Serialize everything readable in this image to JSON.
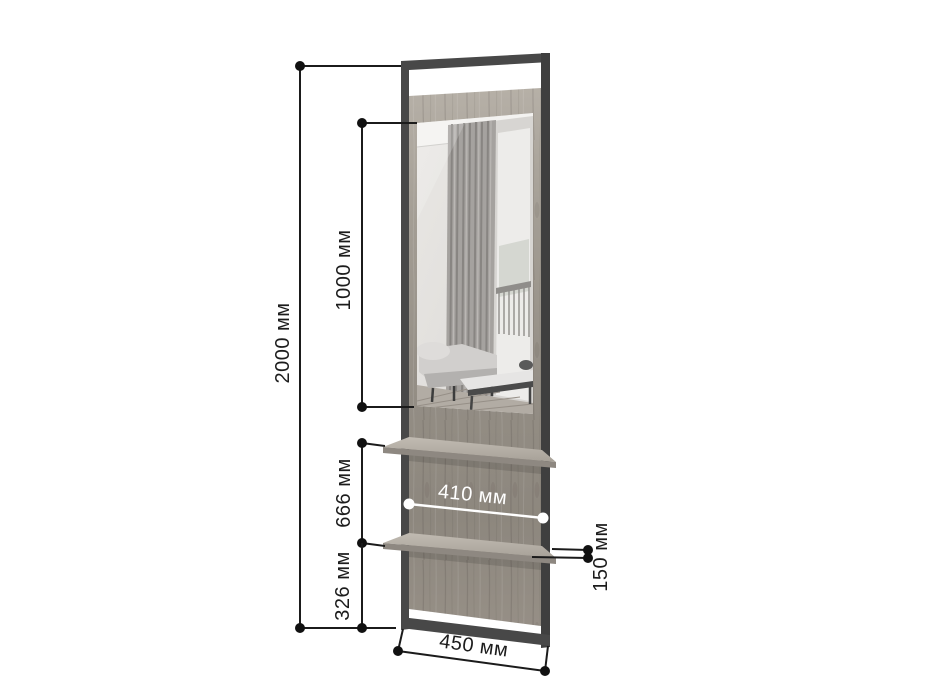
{
  "diagram": {
    "kind": "furniture dimension drawing",
    "product": "floor standing mirror with metal frame and two shelves",
    "unit": "мм"
  },
  "dimensions": {
    "total_height": {
      "value": 2000,
      "label": "2000 мм"
    },
    "mirror_height": {
      "value": 1000,
      "label": "1000 мм"
    },
    "shelf_section": {
      "value": 666,
      "label": "666 мм"
    },
    "lower_section": {
      "value": 326,
      "label": "326 мм"
    },
    "panel_width": {
      "value": 410,
      "label": "410 мм"
    },
    "shelf_depth": {
      "value": 150,
      "label": "150 мм"
    },
    "base_width": {
      "value": 450,
      "label": "450 мм"
    }
  },
  "colors": {
    "background": "#ffffff",
    "dimension_lines": "#1b1b1b",
    "metal_frame": "#484848",
    "wood_panel": "#9a948b",
    "panel_dimension": "#ffffff"
  }
}
